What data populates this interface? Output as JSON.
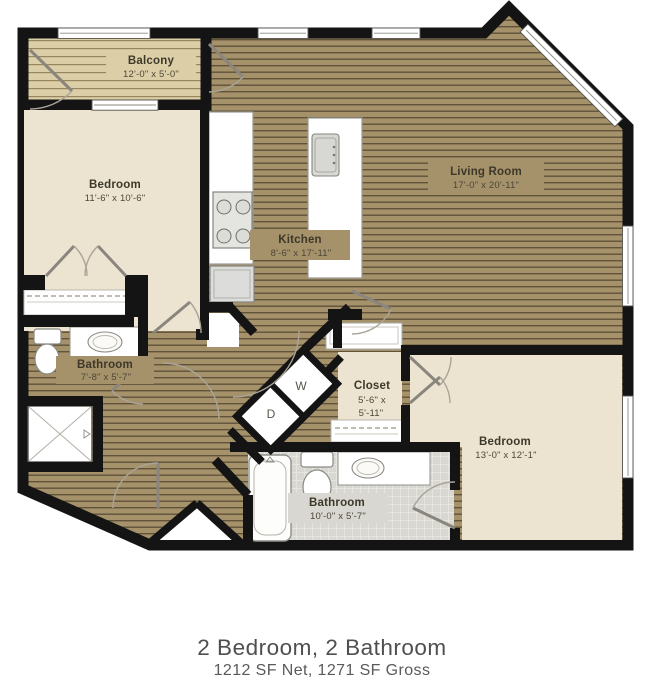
{
  "plan": {
    "rooms": [
      {
        "id": "balcony",
        "label": "Balcony",
        "dims": "12'-0\" x 5'-0\""
      },
      {
        "id": "bedroom1",
        "label": "Bedroom",
        "dims": "11'-6\" x 10'-6\""
      },
      {
        "id": "living",
        "label": "Living Room",
        "dims": "17'-0\" x 20'-11\""
      },
      {
        "id": "kitchen",
        "label": "Kitchen",
        "dims": "8'-6\" x 17'-11\""
      },
      {
        "id": "bathroom1",
        "label": "Bathroom",
        "dims": "7'-8\" x 5'-7\""
      },
      {
        "id": "closet",
        "label": "Closet",
        "dims": "5'-6\" x",
        "dims2": "5'-11\""
      },
      {
        "id": "bathroom2",
        "label": "Bathroom",
        "dims": "10'-0\" x 5'-7\""
      },
      {
        "id": "bedroom2",
        "label": "Bedroom",
        "dims": "13'-0\" x 12'-1\""
      }
    ],
    "washer_label": "W",
    "dryer_label": "D",
    "colors": {
      "wall": "#141414",
      "wood_floor": "#a5926a",
      "wood_stripe": "#60533a",
      "deck": "#dccfa8",
      "deck_stripe": "#97865d",
      "carpet_cream": "#ece4d1",
      "tile": "#d8d7d1",
      "label_text": "#3d3829",
      "caption_text": "#4f4f4f"
    }
  },
  "caption": {
    "title": "2 Bedroom, 2 Bathroom",
    "subtitle": "1212 SF Net, 1271 SF Gross"
  }
}
